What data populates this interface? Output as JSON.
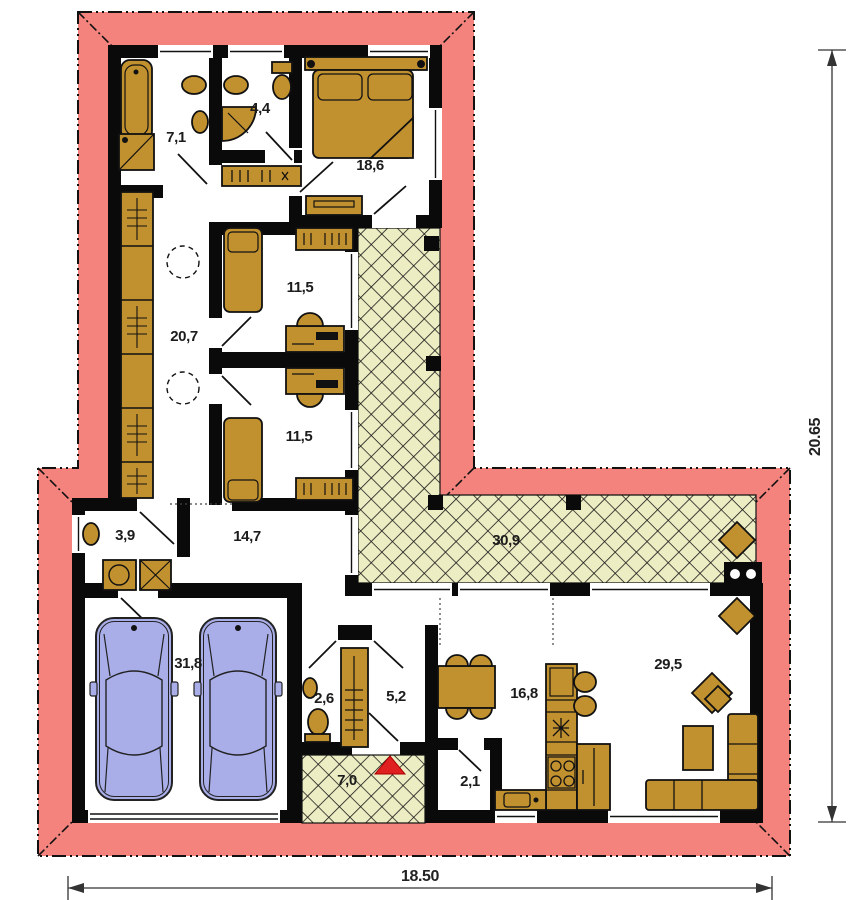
{
  "rooms": {
    "bathroom": "7,1",
    "wc": "4,4",
    "bedroom_main": "18,6",
    "bedroom_one": "11,5",
    "corridor": "20,7",
    "bedroom_two": "11,5",
    "vestibule": "3,9",
    "hall": "14,7",
    "terrace": "30,9",
    "garage": "31,8",
    "wc_small": "2,6",
    "hallway": "5,2",
    "porch": "7,0",
    "pantry": "2,1",
    "kitchen": "16,8",
    "living_room": "29,5"
  },
  "dimensions": {
    "width": "18.50",
    "height": "20.65"
  },
  "colors": {
    "roof": "#F4837D",
    "wall": "#0A0A0A",
    "furniture": "#C2912F",
    "terrace_fill": "#EDEDC4",
    "car": "#A9AEE9",
    "entrance_marker": "#E02020"
  }
}
